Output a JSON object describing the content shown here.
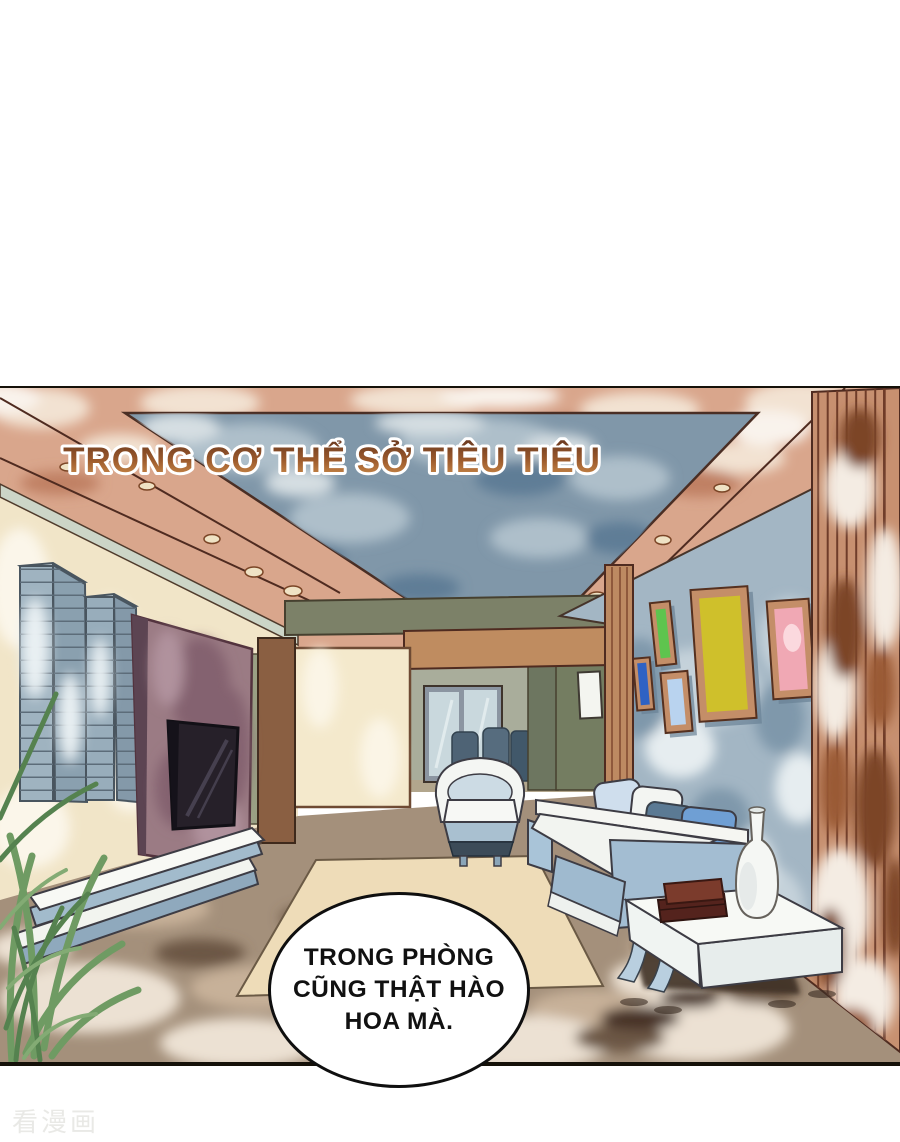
{
  "caption": {
    "text": "TRONG CƠ THỂ SỞ TIÊU TIÊU",
    "fill_top": "#6b3a20",
    "fill_bottom": "#d2924f",
    "outline": "#ffffff"
  },
  "speech_bubble": {
    "lines": [
      "TRONG PHÒNG",
      "CŨNG THẬT HÀO",
      "HOA MÀ."
    ],
    "text_color": "#111111",
    "fill": "#ffffff",
    "border": "#0f0f0f"
  },
  "watermark": {
    "text": "看漫画",
    "color": "#e9e9e6"
  },
  "palette": {
    "page_background": "#ffffff",
    "panel_border": "#151109",
    "ceiling_salmon": "#d9a68c",
    "ceiling_tray_blue": "#8097a9",
    "wall_cream": "#f1e5c8",
    "wall_blue_gray": "#a3b6c4",
    "slat_wall_brown": "#c79070",
    "floor_brown": "#a4907b",
    "rug_cream": "#eedcb8",
    "tv_panel_mauve": "#9b7b84",
    "sofa_blue": "#a3bdd2",
    "frame_green": "#5ec44e",
    "frame_blue": "#2f62c4",
    "frame_light_blue": "#b9d3ef",
    "frame_yellow": "#cfc02b",
    "frame_pink": "#f0a8b4",
    "books_maroon": "#54231d",
    "plant_green": "#6f9b63"
  }
}
